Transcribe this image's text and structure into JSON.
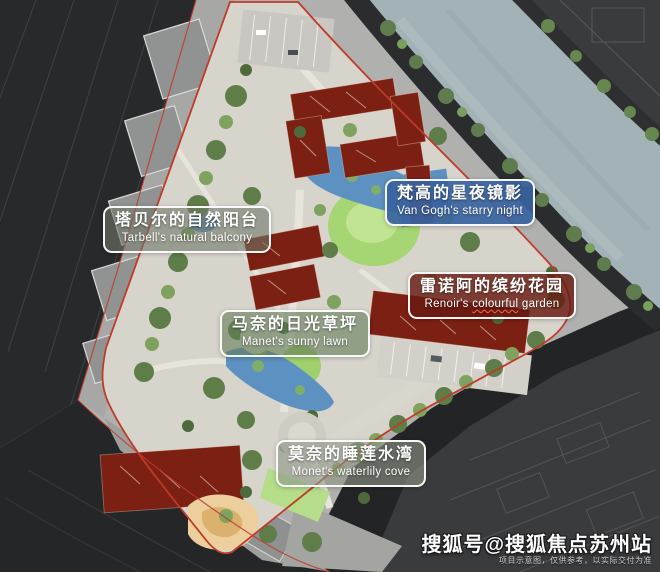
{
  "image": {
    "description": "Aerial masterplan rendering of a riverside residential community with five painter-themed landscape zones",
    "width_px": 660,
    "height_px": 572
  },
  "labels": {
    "tarbell": {
      "zh": "塔贝尔的自然阳台",
      "en": "Tarbell's natural balcony"
    },
    "vangogh": {
      "zh": "梵高的星夜镜影",
      "en": "Van Gogh's starry night"
    },
    "renoir": {
      "zh": "雷诺阿的缤纷花园",
      "en_prefix": "Renoir's ",
      "en_underlined": "colourful",
      "en_suffix": " garden"
    },
    "manet": {
      "zh": "马奈的日光草坪",
      "en": "Manet's sunny lawn"
    },
    "monet": {
      "zh": "莫奈的睡莲水湾",
      "en": "Monet's waterlily cove"
    }
  },
  "watermark": {
    "main": "搜狐号@搜狐焦点苏州站",
    "disclaimer": "项目示意图，仅供参考，以实际交付为准"
  },
  "colors": {
    "boundary_red": "#c03a29",
    "building_roof_maroon": "#7c2013",
    "canal_water": "#a3b2b6",
    "pond_blue": "#5d91c1",
    "lawn_green": "#a6d573",
    "dark_road": "#28292b",
    "label_border_white": "#ffffff",
    "vangogh_label_blue": "#3863a0",
    "renoir_label_maroon": "#681b11",
    "spellcheck_underline_red": "#ff5246"
  }
}
